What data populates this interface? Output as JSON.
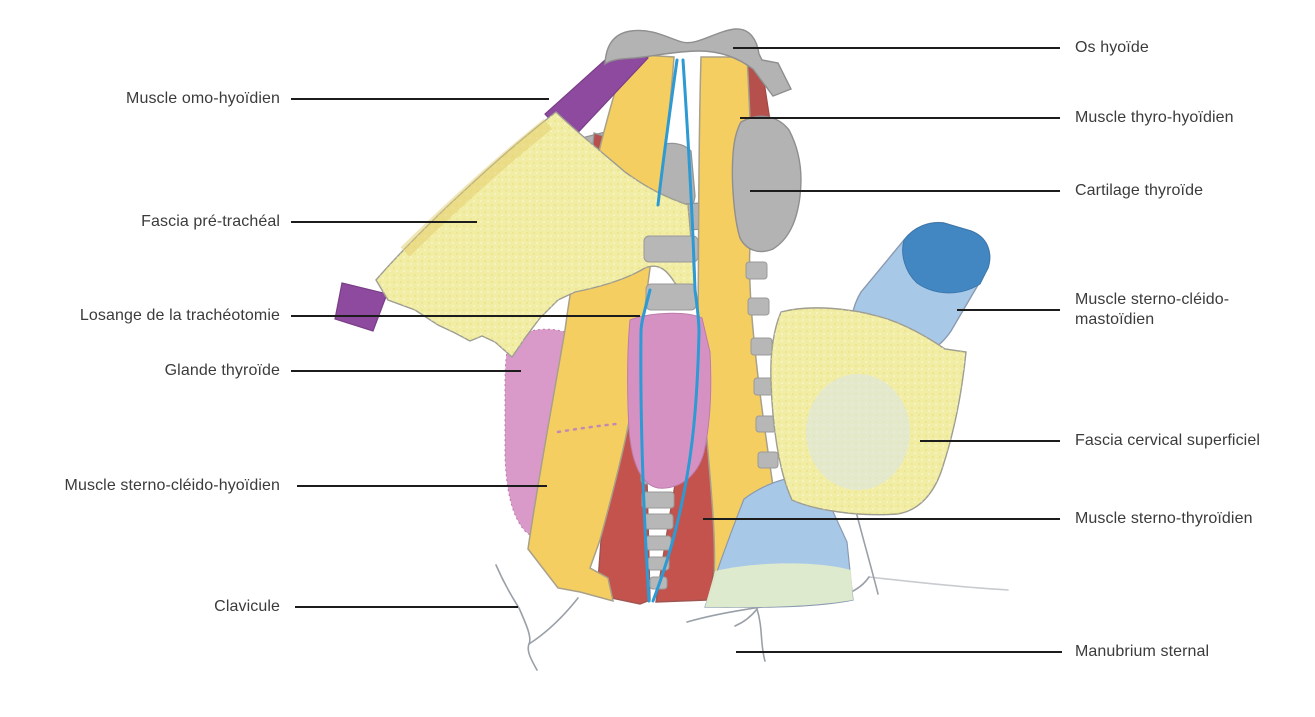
{
  "figure": {
    "type": "hand-drawn anatomical diagram",
    "subject": "anatomie du cou / trachéotomie",
    "background": "#ffffff"
  },
  "labels": {
    "left": [
      {
        "text": "Muscle omo-hyoïdien"
      },
      {
        "text": "Fascia pré-trachéal"
      },
      {
        "text": "Losange de la trachéotomie"
      },
      {
        "text": "Glande thyroïde"
      },
      {
        "text": "Muscle sterno-cléido-hyoïdien"
      },
      {
        "text": "Clavicule"
      }
    ],
    "right": [
      {
        "text": "Os hyoïde"
      },
      {
        "text": "Muscle thyro-hyoïdien"
      },
      {
        "text": "Cartilage thyroïde"
      },
      {
        "text": "Muscle sterno-cléido-mastoïdien"
      },
      {
        "text": "Fascia cervical superficiel"
      },
      {
        "text": "Muscle sterno-thyroïdien"
      },
      {
        "text": "Manubrium sternal"
      }
    ]
  },
  "palette": {
    "yellowMuscle": "#F5CE62",
    "fasciaYellow": "#F2EDA4",
    "purpleMuscle": "#8E4A9E",
    "redMuscle": "#C4534E",
    "darkRedMuscle": "#B5504C",
    "pinkGland": "#D99AC9",
    "pinkIsthmus": "#D691C3",
    "boneGray": "#B3B3B3",
    "trachealRing": "#B7B7B7",
    "losangeBlue": "#2D9AD3",
    "scmBlue": "#A8C8E8",
    "scmBlueDark": "#4387C2",
    "scmGreen": "#E3EDCB",
    "fasciaBlueTint": "#D9E5ED",
    "sketch": "#9AA0A8",
    "leaderLine": "#1C1C1C",
    "labelText": "#3B3B3B"
  }
}
